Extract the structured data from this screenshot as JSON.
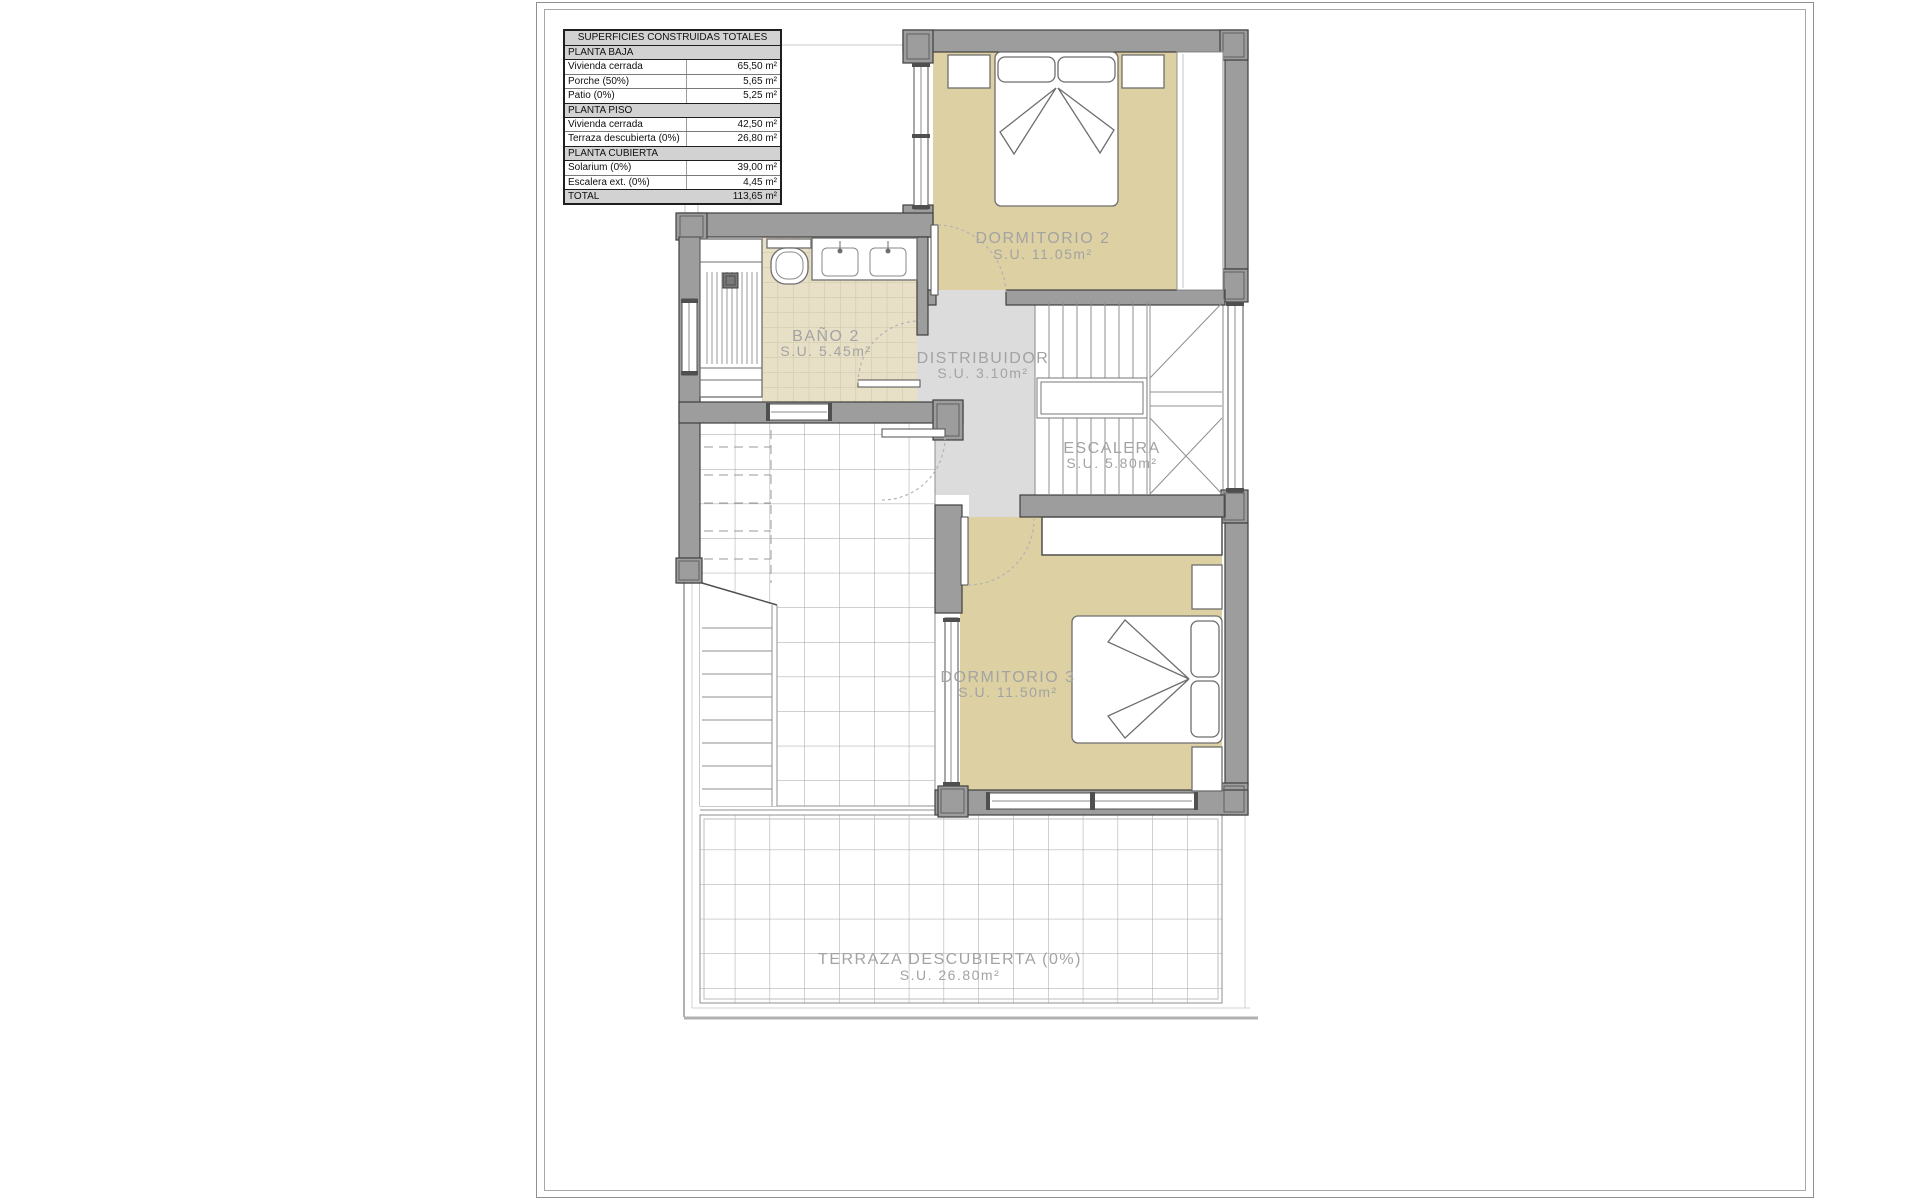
{
  "table": {
    "title": "SUPERFICIES CONSTRUIDAS TOTALES",
    "rows": [
      {
        "label": "PLANTA BAJA",
        "value": "",
        "type": "section"
      },
      {
        "label": "Vivienda cerrada",
        "value": "65,50 m²",
        "type": "data"
      },
      {
        "label": "Porche (50%)",
        "value": "5,65 m²",
        "type": "data"
      },
      {
        "label": "Patio (0%)",
        "value": "5,25 m²",
        "type": "data"
      },
      {
        "label": "PLANTA PISO",
        "value": "",
        "type": "section"
      },
      {
        "label": "Vivienda cerrada",
        "value": "42,50 m²",
        "type": "data"
      },
      {
        "label": "Terraza descubierta (0%)",
        "value": "26,80 m²",
        "type": "data"
      },
      {
        "label": "PLANTA CUBIERTA",
        "value": "",
        "type": "section"
      },
      {
        "label": "Solarium (0%)",
        "value": "39,00 m²",
        "type": "data"
      },
      {
        "label": "Escalera ext. (0%)",
        "value": "4,45 m²",
        "type": "data"
      },
      {
        "label": "TOTAL",
        "value": "113,65 m²",
        "type": "total"
      }
    ]
  },
  "rooms": [
    {
      "id": "dormitorio-2",
      "name": "DORMITORIO 2",
      "area": "S.U. 11.05m²"
    },
    {
      "id": "bano-2",
      "name": "BAÑO 2",
      "area": "S.U. 5.45m²"
    },
    {
      "id": "distribuidor",
      "name": "DISTRIBUIDOR",
      "area": "S.U. 3.10m²"
    },
    {
      "id": "escalera",
      "name": "ESCALERA",
      "area": "S.U. 5.80m²"
    },
    {
      "id": "dormitorio-3",
      "name": "DORMITORIO 3",
      "area": "S.U. 11.50m²"
    },
    {
      "id": "terraza",
      "name": "TERRAZA DESCUBIERTA (0%)",
      "area": "S.U. 26.80m²"
    }
  ],
  "colors": {
    "wall": "#9d9d9d",
    "wall_outline": "#3f3f3f",
    "bedroom_floor": "#ddd0a2",
    "bath_floor": "#e7dfc6",
    "hall_floor": "#dcdcdc",
    "label_text": "#a3a3a3",
    "table_section_bg": "#d2d2d2"
  }
}
